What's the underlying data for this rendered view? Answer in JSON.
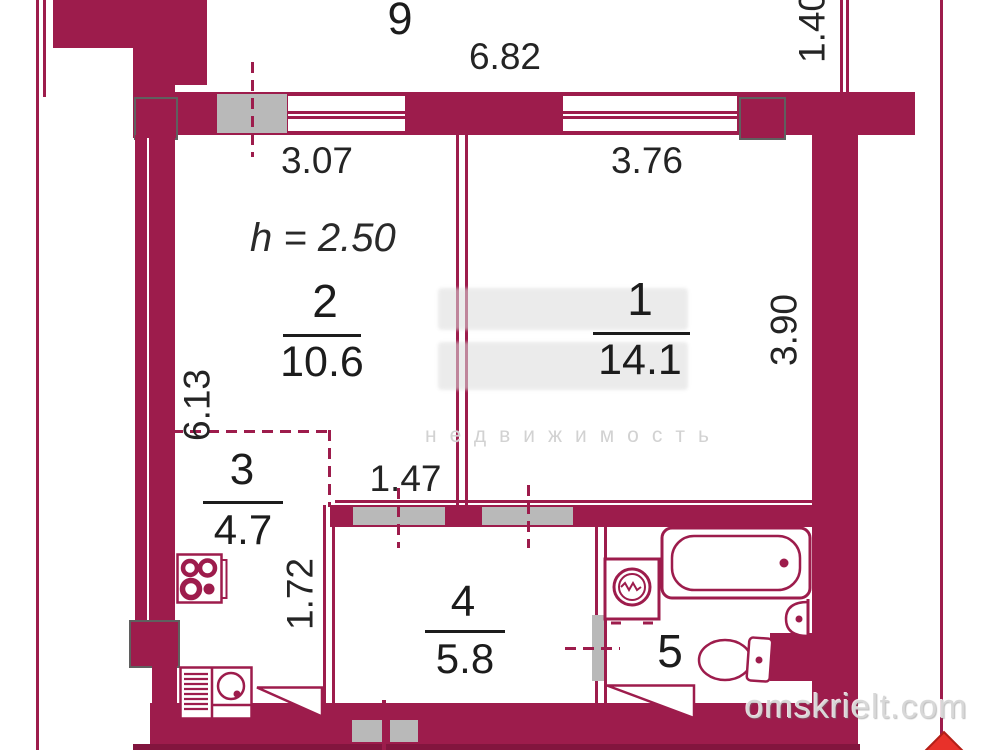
{
  "plan": {
    "title": "apartment floor plan",
    "ceiling_height": "h = 2.50",
    "balcony_number": "9",
    "rooms": [
      {
        "number": "1",
        "area": "14.1"
      },
      {
        "number": "2",
        "area": "10.6"
      },
      {
        "number": "3",
        "area": "4.7"
      },
      {
        "number": "4",
        "area": "5.8"
      },
      {
        "number": "5",
        "area": ""
      }
    ],
    "dims": {
      "overall_top": "6.82",
      "window_left": "3.07",
      "window_right": "3.76",
      "balcony_depth": "1.40",
      "room1_height": "3.90",
      "left_height": "6.13",
      "kitchen_height": "1.72",
      "door_width": "1.47"
    },
    "watermark": {
      "site": "omskrielt.com",
      "caption": "недвижимость"
    },
    "colors": {
      "wall": "#9d1c4c",
      "opening_gray": "#b9b9b9",
      "marker_red": "#e8312a"
    }
  }
}
